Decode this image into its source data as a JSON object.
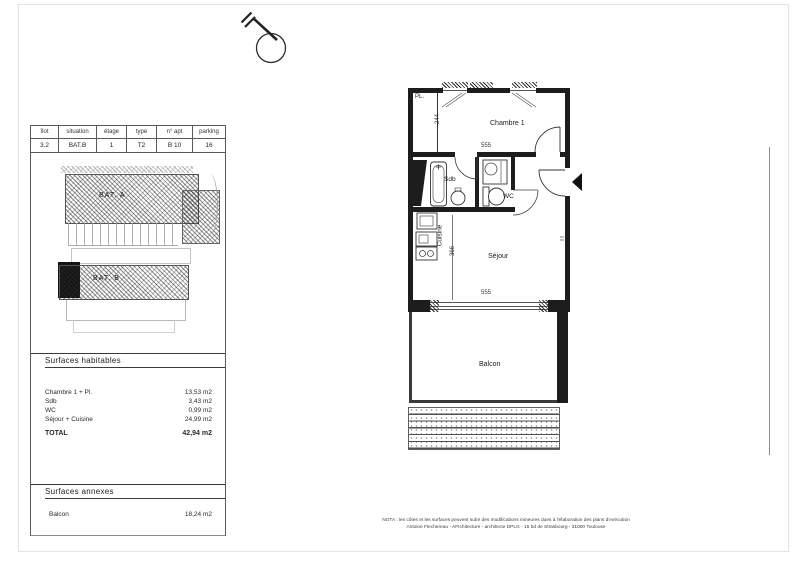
{
  "info_table": {
    "headers": [
      "îlot",
      "situation",
      "étage",
      "type",
      "n° apt",
      "parking"
    ],
    "values": [
      "3.2",
      "BAT.B",
      "1",
      "T2",
      "B 10",
      "16"
    ]
  },
  "site_plan": {
    "bat_a_label": "BAT. A",
    "bat_b_label": "BAT. B"
  },
  "surfaces_habitables": {
    "title": "Surfaces habitables",
    "rows": [
      {
        "label": "Chambre 1 + Pl.",
        "value": "13,53 m2"
      },
      {
        "label": "Sdb",
        "value": "3,43 m2"
      },
      {
        "label": "WC",
        "value": "0,99 m2"
      },
      {
        "label": "Séjour + Cuisine",
        "value": "24,99 m2"
      }
    ],
    "total_label": "TOTAL",
    "total_value": "42,94 m2"
  },
  "surfaces_annexes": {
    "title": "Surfaces annexes",
    "rows": [
      {
        "label": "Balcon",
        "value": "18,24 m2"
      }
    ]
  },
  "floor_plan": {
    "rooms": {
      "placard": "PL.",
      "chambre": "Chambre 1",
      "sdb": "Sdb",
      "wc": "WC",
      "cuisine": "Cuisine",
      "sejour": "Séjour",
      "balcon": "Balcon"
    },
    "dimensions": {
      "chambre_height": "244",
      "chambre_width": "555",
      "sejour_height": "366",
      "sejour_width": "555"
    }
  },
  "footer": {
    "line1": "NOTA : les côtes et les surfaces peuvent subir des modifications mineures dues à l'élaboration des plans d'exécution",
    "line2": "Antoine Flechereau - AFIchitecture - architecte DPLG - 15 bd de Strasbourg - 31000 Toulouse"
  },
  "colors": {
    "ink": "#1d1d1d",
    "hatch_gray": "#9a9a9a"
  }
}
